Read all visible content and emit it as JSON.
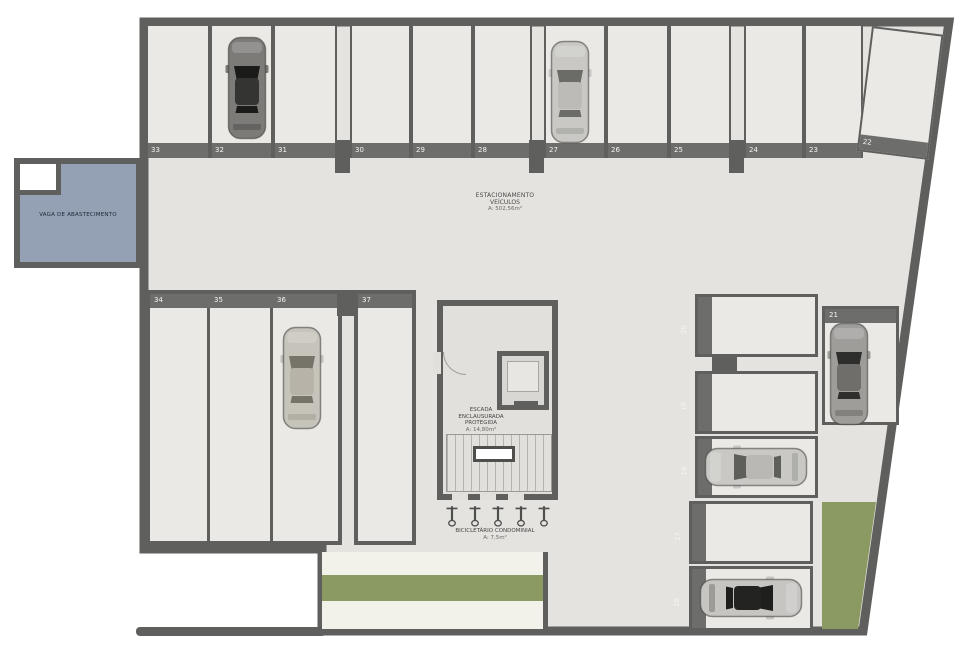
{
  "labels": {
    "garage_area": {
      "line1": "ESTACIONAMENTO",
      "line2": "VEÍCULOS",
      "line3": "A: 502,56m²"
    },
    "fuel_bay": {
      "line1": "VAGA DE ABASTECIMENTO"
    },
    "stairwell": {
      "line1": "ESCADA",
      "line2": "ENCLAUSURADA",
      "line3": "PROTEGIDA",
      "line4": "A: 14,80m²"
    },
    "bike_parking": {
      "line1": "BICICLETÁRIO CONDOMINIAL",
      "line2": "A: 7,5m²"
    }
  },
  "stalls": {
    "top_row": [
      "33",
      "32",
      "31",
      "30",
      "29",
      "28",
      "27",
      "26",
      "25",
      "24",
      "23"
    ],
    "angled": "22",
    "lower_left": [
      "34",
      "35",
      "36",
      "37"
    ],
    "right_column": [
      "20",
      "19",
      "18",
      "17",
      "16"
    ],
    "right_vertical": "21"
  },
  "cars": {
    "count": 6,
    "occupied_stalls": [
      "32",
      "27",
      "36",
      "21",
      "18",
      "16"
    ]
  },
  "colors": {
    "wall": "#5f5f5d",
    "floor": "#e4e3e0",
    "stallFill": "#eae9e6",
    "band": "#6d6d6b",
    "fuelBlue": "#94a0b4",
    "grass": "#8b9a63",
    "pale": "#f2f1ea",
    "carSilver": "#c9c8c5",
    "carDark": "#7c7b78",
    "numberText": "#f5f5f4"
  }
}
